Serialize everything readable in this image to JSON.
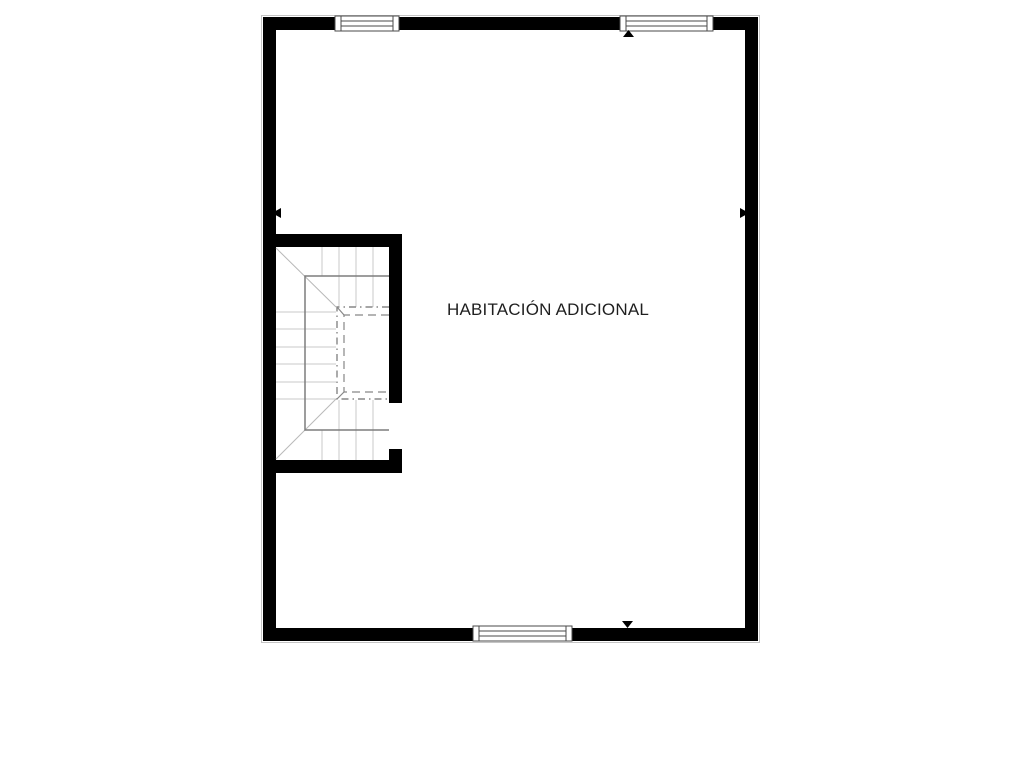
{
  "floorplan": {
    "room_label": "HABITACIÓN ADICIONAL",
    "colors": {
      "wall": "#000000",
      "wall_outline": "#c4c4c4",
      "window_fill": "#ffffff",
      "window_stroke": "#4a4a4a",
      "stair_rail": "#7d7d7d",
      "stair_tread": "#c9c9c9",
      "stair_diagonal": "#b8b8b8",
      "void_outline": "#878787",
      "marker": "#000000",
      "label_text": "#1f1f1f"
    },
    "elements": {
      "windows": [
        {
          "name": "window-top-left",
          "wall": "top"
        },
        {
          "name": "window-top-right",
          "wall": "top"
        },
        {
          "name": "window-bottom",
          "wall": "bottom"
        }
      ],
      "markers": [
        {
          "name": "direction-marker-top",
          "direction": "up"
        },
        {
          "name": "direction-marker-bottom",
          "direction": "down"
        },
        {
          "name": "direction-marker-left",
          "direction": "left"
        },
        {
          "name": "direction-marker-right",
          "direction": "right"
        }
      ],
      "staircase": {
        "name": "staircase",
        "type": "u-shaped-winder"
      }
    }
  }
}
